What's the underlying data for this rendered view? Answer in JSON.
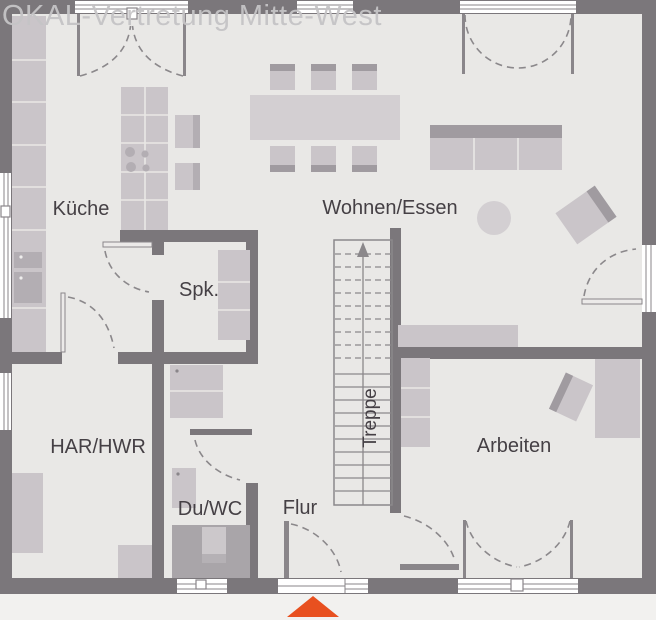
{
  "watermark": "OKAL-Vertretung Mitte-West",
  "rooms": {
    "kueche": "Küche",
    "wohnen_essen": "Wohnen/Essen",
    "spk": "Spk.",
    "har_hwr": "HAR/HWR",
    "du_wc": "Du/WC",
    "flur": "Flur",
    "arbeiten": "Arbeiten",
    "treppe": "Treppe"
  },
  "colors": {
    "wall": "#7b777b",
    "floor": "#e9e8e6",
    "outside": "#f2f1ef",
    "furniture": "#cac5c9",
    "furniture_dark": "#a09ba0",
    "furniture_mid": "#b3aeb3",
    "table": "#d3cfd2",
    "line": "#8b888b",
    "frame": "#8a868a",
    "text": "#454045",
    "watermark": "#c5c4c6",
    "window_white": "#ffffff",
    "arrow": "#e8501f"
  }
}
